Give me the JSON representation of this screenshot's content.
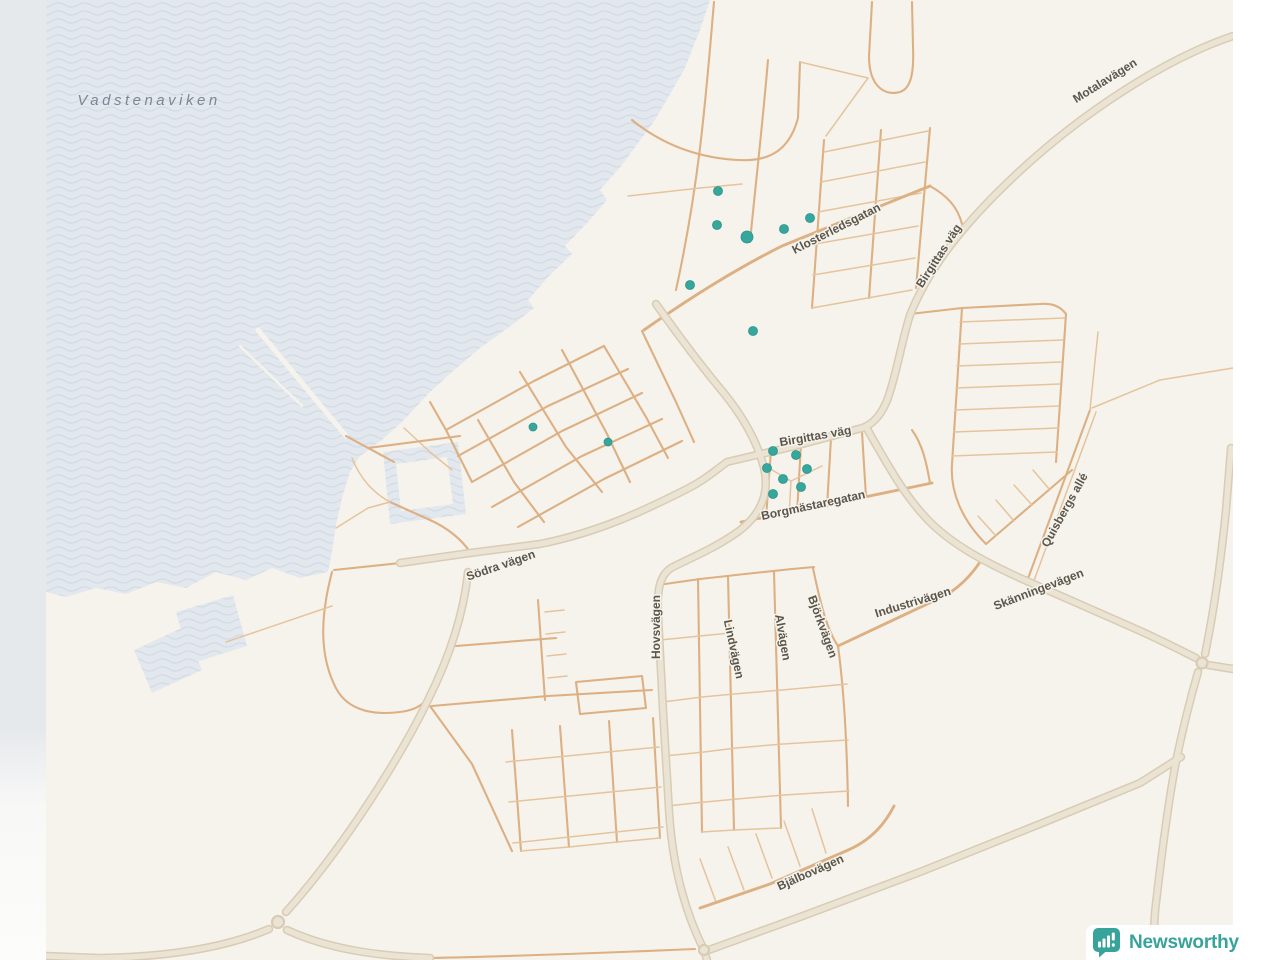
{
  "water": {
    "label": "Vadstenaviken"
  },
  "streets": {
    "klosterledsgatan": "Klosterledsgatan",
    "motalavagen": "Motalavägen",
    "birgittas_vag_ne": "Birgittas väg",
    "birgittas_vag": "Birgittas väg",
    "borgmastaregatan": "Borgmästaregatan",
    "sodra_vagen": "Södra vägen",
    "hovsvagen": "Hovsvägen",
    "lindvagen": "Lindvägen",
    "alvagen": "Alvägen",
    "bjorkvagen": "Björkvägen",
    "industrivagen": "Industrivägen",
    "skanningevagen": "Skänningevägen",
    "quisbergs_alle": "Quisbergs allé",
    "bjalbovagen": "Bjälbovägen"
  },
  "markers": {
    "points": [
      [
        718,
        191,
        4.5
      ],
      [
        717,
        225,
        4.5
      ],
      [
        747,
        237,
        6
      ],
      [
        784,
        229,
        4.5
      ],
      [
        810,
        218,
        4.5
      ],
      [
        690,
        285,
        4.5
      ],
      [
        753,
        331,
        4.5
      ],
      [
        533,
        427,
        4
      ],
      [
        608,
        442,
        4
      ],
      [
        773,
        451,
        4.5
      ],
      [
        796,
        455,
        4.5
      ],
      [
        767,
        468,
        4.5
      ],
      [
        807,
        469,
        4.5
      ],
      [
        783,
        479,
        4.5
      ],
      [
        801,
        487,
        4.5
      ],
      [
        773,
        494,
        4.5
      ]
    ]
  },
  "attribution": {
    "brand": "Newsworthy"
  },
  "colors": {
    "land": "#f6f3ec",
    "water": "#e3e8ee",
    "wave": "#d2dbe4",
    "road_minor": "#ddb083",
    "road_thin": "#e5c49c",
    "major_fill": "#ebe4d4",
    "major_casing": "#d8ccb4",
    "label": "#5b564b",
    "water_label": "#7b8794",
    "marker": "#35a79c",
    "marker_edge": "#2c9289",
    "brand": "#38a39a"
  }
}
